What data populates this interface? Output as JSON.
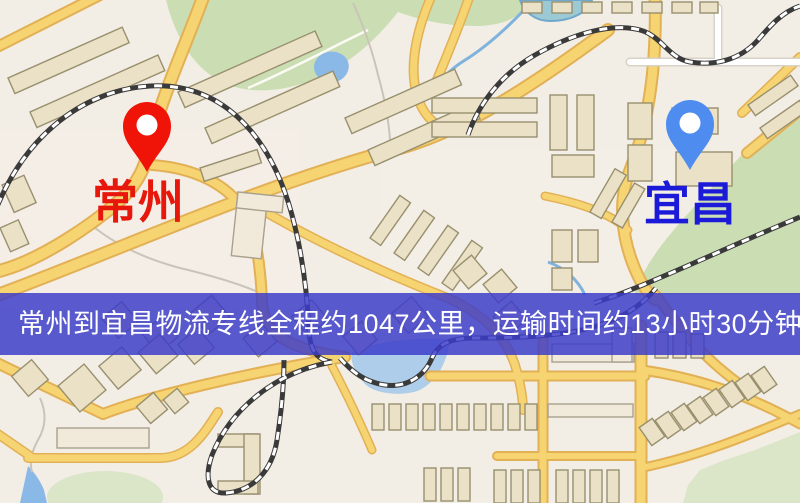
{
  "map": {
    "description": "road map with parks, lakes, railways and buildings",
    "palette": {
      "background": "#f3eee5",
      "road_yellow": "#f7d472",
      "road_casing": "#e2b055",
      "white_road": "#ffffff",
      "park_green": "#cbdeb3",
      "water_blue": "#8ab9e8",
      "building_tan": "#eae1c6",
      "railway_dark": "#3a3a3a"
    }
  },
  "markers": {
    "origin": {
      "label": "常州",
      "label_color": "#e8170c",
      "pin_color": "#f01408",
      "pin_hole_color": "#ffffff"
    },
    "destination": {
      "label": "宜昌",
      "label_color": "#1a1ad8",
      "pin_color": "#4f8cf0",
      "pin_hole_color": "#ffffff"
    }
  },
  "banner": {
    "text": "常州到宜昌物流专线全程约1047公里，运输时间约13小时30分钟.",
    "background": "rgba(60,60,201,0.84)",
    "text_color": "#ffffff"
  },
  "route_info": {
    "origin": "常州",
    "destination": "宜昌",
    "service": "物流专线",
    "distance_km": "1047",
    "duration": "13小时30分钟"
  }
}
